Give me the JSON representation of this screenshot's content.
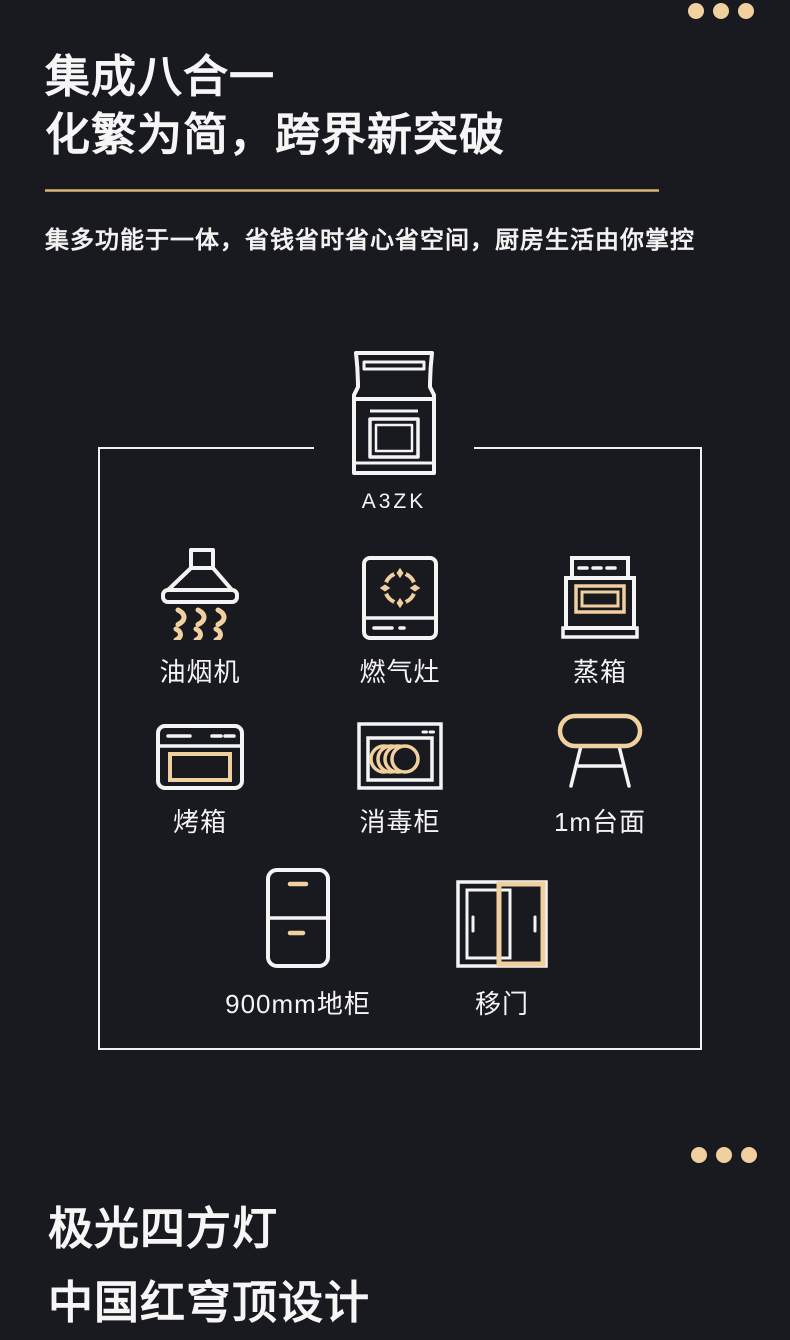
{
  "colors": {
    "background": "#181a1f",
    "gold_accent": "#f0d09e",
    "gold_divider": "#cbaa6e",
    "white": "#f5f5f5"
  },
  "hero": {
    "title_line1": "集成八合一",
    "title_line2": "化繁为简，跨界新突破",
    "subtitle": "集多功能于一体，省钱省时省心省空间，厨房生活由你掌控"
  },
  "diagram": {
    "model_label": "A3ZK",
    "model_icon": "integrated-stove-icon",
    "items": [
      {
        "label": "油烟机",
        "icon": "range-hood-icon"
      },
      {
        "label": "燃气灶",
        "icon": "gas-stove-icon"
      },
      {
        "label": "蒸箱",
        "icon": "steam-oven-icon"
      },
      {
        "label": "烤箱",
        "icon": "oven-icon"
      },
      {
        "label": "消毒柜",
        "icon": "disinfection-cabinet-icon"
      },
      {
        "label": "1m台面",
        "icon": "countertop-icon"
      },
      {
        "label": "900mm地柜",
        "icon": "base-cabinet-icon"
      },
      {
        "label": "移门",
        "icon": "sliding-door-icon"
      }
    ]
  },
  "footer": {
    "title_line1": "极光四方灯",
    "title_line2": "中国红穹顶设计"
  },
  "decor": {
    "ellipsis_dots_top": 3,
    "ellipsis_dots_bottom": 3
  }
}
